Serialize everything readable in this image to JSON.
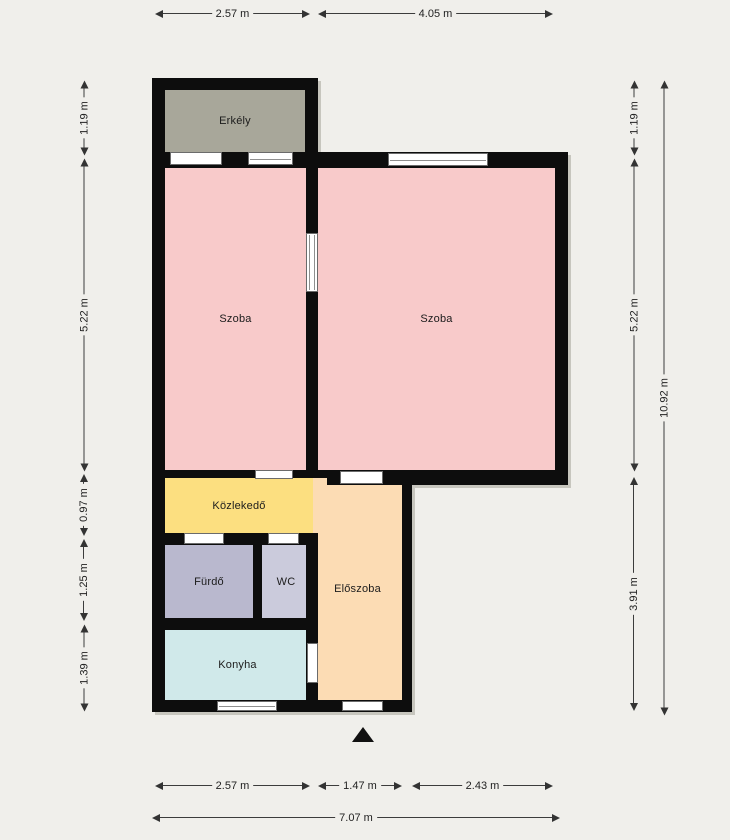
{
  "rooms": {
    "erkely": {
      "label": "Erkély"
    },
    "szoba_left": {
      "label": "Szoba"
    },
    "szoba_right": {
      "label": "Szoba"
    },
    "kozlekedo": {
      "label": "Közlekedő"
    },
    "furdo": {
      "label": "Fürdő"
    },
    "wc": {
      "label": "WC"
    },
    "eloszoba": {
      "label": "Előszoba"
    },
    "konyha": {
      "label": "Konyha"
    }
  },
  "dims": {
    "top": [
      {
        "label": "2.57 m"
      },
      {
        "label": "4.05 m"
      }
    ],
    "left": [
      {
        "label": "1.19 m"
      },
      {
        "label": "5.22 m"
      },
      {
        "label": "0.97 m"
      },
      {
        "label": "1.25 m"
      },
      {
        "label": "1.39 m"
      }
    ],
    "right_inner": [
      {
        "label": "1.19 m"
      },
      {
        "label": "5.22 m"
      },
      {
        "label": "3.91 m"
      }
    ],
    "right_outer": [
      {
        "label": "10.92 m"
      }
    ],
    "bottom": [
      {
        "label": "2.57 m"
      },
      {
        "label": "1.47 m"
      },
      {
        "label": "2.43 m"
      }
    ],
    "bottom_total": [
      {
        "label": "7.07 m"
      }
    ]
  },
  "markers": {
    "entrance": "entrance-arrow"
  },
  "colors": {
    "background": "#f0efeb",
    "wall": "#0d0d0d",
    "window_fill": "#ffffff",
    "dimension_ink": "#333333",
    "rooms": {
      "erkely": "#a8a79a",
      "szoba_left": "#f8caca",
      "szoba_right": "#f8caca",
      "kozlekedo": "#fcdf80",
      "furdo": "#b9b8ce",
      "wc": "#cbcbdc",
      "eloszoba": "#fcdcb4",
      "konyha": "#d0e9ea"
    }
  }
}
